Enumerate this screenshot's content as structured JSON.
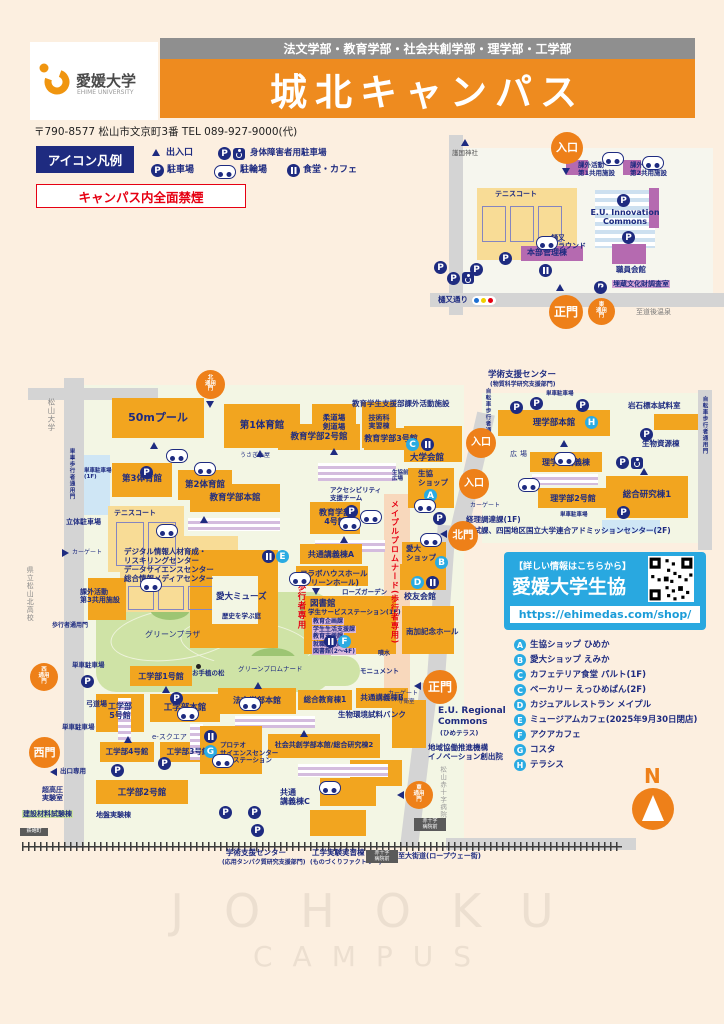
{
  "icons": {
    "p": "P"
  },
  "header": {
    "faculties": "法文学部・教育学部・社会共創学部・理学部・工学部",
    "campus": "城北キャンパス",
    "univ_ja": "愛媛大学",
    "univ_en": "EHIME UNIVERSITY",
    "address": "〒790-8577 松山市文京町3番 TEL 089-927-9000(代)"
  },
  "legend": {
    "title": "アイコン凡例",
    "entrance": "出入口",
    "parking": "駐車場",
    "accessible": "身体障害者用駐車場",
    "bicycle": "駐輪場",
    "cafeteria": "食堂・カフェ",
    "no_smoking": "キャンパス内全面禁煙"
  },
  "north_map": {
    "shrine": "護国神社",
    "entrance": "入口",
    "tennis": "テニスコート",
    "ground": "樋又\nグラウンド",
    "club1": "課外活動\n第1共用施設",
    "club2": "課外活動\n第2共用施設",
    "euic": "E.U. Innovation\nCommons",
    "admin": "本部管理棟",
    "staff_hall": "職員会館",
    "cultural": "埋蔵文化財調査室",
    "main_gate": "正門",
    "east_gate": "東\n通用\n門",
    "street": "樋又通り",
    "dogo": "至道後温泉"
  },
  "main_map": {
    "gates": {
      "north_service": "北\n通用\n門",
      "entrance": "入口",
      "north": "北門",
      "main": "正門",
      "west_service": "西\n通用\n門",
      "west": "西門",
      "east_service": "東\n通用\n門",
      "exit_only": "出口専用",
      "car_gate": "カーゲート",
      "guard": "守衛室",
      "ped": "歩行者通用門",
      "bike_ped": "自転車歩行者通用門",
      "moto_ped": "単車歩行者通用門"
    },
    "streets": {
      "matsuyama_univ": "松山大学",
      "kita_hs": "県立松山北高校",
      "redcross": "松山赤十字病院",
      "okaido": "至大街道(ロープウェー街)",
      "maple": "メイプルプロムナード(歩行者専用)",
      "ped_only": "歩行者専用",
      "tram1": "鉄砲町",
      "tram2": "赤十字\n病院前"
    },
    "areas": {
      "green_plaza": "グリーンプラザ",
      "green_prom": "グリーンプロムナード",
      "history": "歴史を学ぶ庭",
      "pine": "お手植の松",
      "monument": "モニュメント",
      "fountain": "噴水",
      "rose": "ローズガーデン",
      "esquare": "e-スクエア",
      "plaza": "広場",
      "coop_plaza": "生協前\n広場",
      "rabbit": "うさぎ小屋",
      "tennis": "テニスコート"
    },
    "buildings": {
      "pool": "50mプール",
      "gym1": "第1体育館",
      "judo": "柔道場\n剣道場",
      "tech": "技術科\n実習棟",
      "gym3": "第3体育館",
      "gym2": "第2体育館",
      "moto_1f": "単車駐車場\n(1F)",
      "p_tower": "立体駐車場",
      "edu2": "教育学部2号館",
      "edu3": "教育学部3号館",
      "edu_support": "教育学生支援部課外活動施設",
      "univ_hall": "大学会館",
      "coop_shop": "生協\nショップ",
      "edu_main": "教育学部本館",
      "accessibility": "アクセシビリティ\n支援チーム",
      "edu4": "教育学部\n4号館",
      "lec_a": "共通講義棟A",
      "aidai_shop": "愛大\nショップ",
      "collabo": "コラボハウスホール\n(グリーンホール)",
      "alumni": "校友会館",
      "library": "図書館",
      "station": "学生サービスステーション(1F)",
      "depts": [
        "教育企画課",
        "学生生活支援課",
        "教育支援課",
        "就職支援課",
        "図書館(2〜4F)"
      ],
      "muse": "愛大ミューズ",
      "nanka": "南加記念ホール",
      "digital": "デジタル情報人材育成・\nリスキリングセンター\nデータサイエンスセンター\n総合情報メディアセンター",
      "club3": "課外活動\n第3共用施設",
      "moto": "単車駐車場",
      "eng1": "工学部1号館",
      "kyudo": "弓道場",
      "eng5": "工学部\n5号館",
      "eng_main": "工学部本館",
      "eng4": "工学部4号館",
      "eng3": "工学部3号館",
      "eng2": "工学部2号館",
      "uhp": "超高圧\n実験室",
      "material": "建設材料試験棟",
      "ground_lab": "地盤実験棟",
      "law": "法文学部本館",
      "gen_edu1": "総合教育棟1",
      "lec_b": "共通講義棟B",
      "bio_bank": "生物環境試料バンク",
      "social": "社会共創学部本館/総合研究棟2",
      "proteo": "プロテオ\nサイエンスセンター\n城北ステーション",
      "eu_reg": "E.U. Regional\nCommons",
      "eu_reg_sub": "(ひめテラス)",
      "innovation": "地域協働推進機構\nイノベーション創出院",
      "lec_c": "共通\n講義棟C",
      "eng_lab": "工学実験実習棟",
      "eng_lab_sub": "(ものづくりファクトリー)",
      "support_s": "学術支援センター",
      "support_s_sub": "(応用タンパク質研究支援部門)",
      "support_n": "学術支援センター",
      "support_n_sub": "(物質科学研究支援部門)",
      "sci_main": "理学部本館",
      "rock": "岩石標本試料室",
      "bio_res": "生物資源棟",
      "sci_lec": "理学部講義棟",
      "sci2": "理学部2号館",
      "res1": "総合研究棟1",
      "keiri": "経理調達課(1F)",
      "admission": "入試課、四国地区国立大学連合アドミッションセンター(2F)"
    }
  },
  "coop_box": {
    "tagline": "【詳しい情報はこちらから】",
    "name": "愛媛大学生協",
    "url": "https://ehimedas.com/shop/"
  },
  "shops": {
    "items": [
      {
        "letter": "A",
        "label": "生協ショップ ひめか"
      },
      {
        "letter": "B",
        "label": "愛大ショップ えみか"
      },
      {
        "letter": "C",
        "label": "カフェテリア食堂 パルト(1F)"
      },
      {
        "letter": "C",
        "label": "ベーカリー えっひめぱん(2F)"
      },
      {
        "letter": "D",
        "label": "カジュアルレストラン メイプル"
      },
      {
        "letter": "E",
        "label": "ミュージアムカフェ(2025年9月30日閉店)"
      },
      {
        "letter": "F",
        "label": "アクアカフェ"
      },
      {
        "letter": "G",
        "label": "コスタ"
      },
      {
        "letter": "H",
        "label": "テラシス"
      }
    ]
  },
  "compass": {
    "n": "N"
  },
  "watermark": {
    "l1": "JOHOKU",
    "l2": "CAMPUS"
  }
}
